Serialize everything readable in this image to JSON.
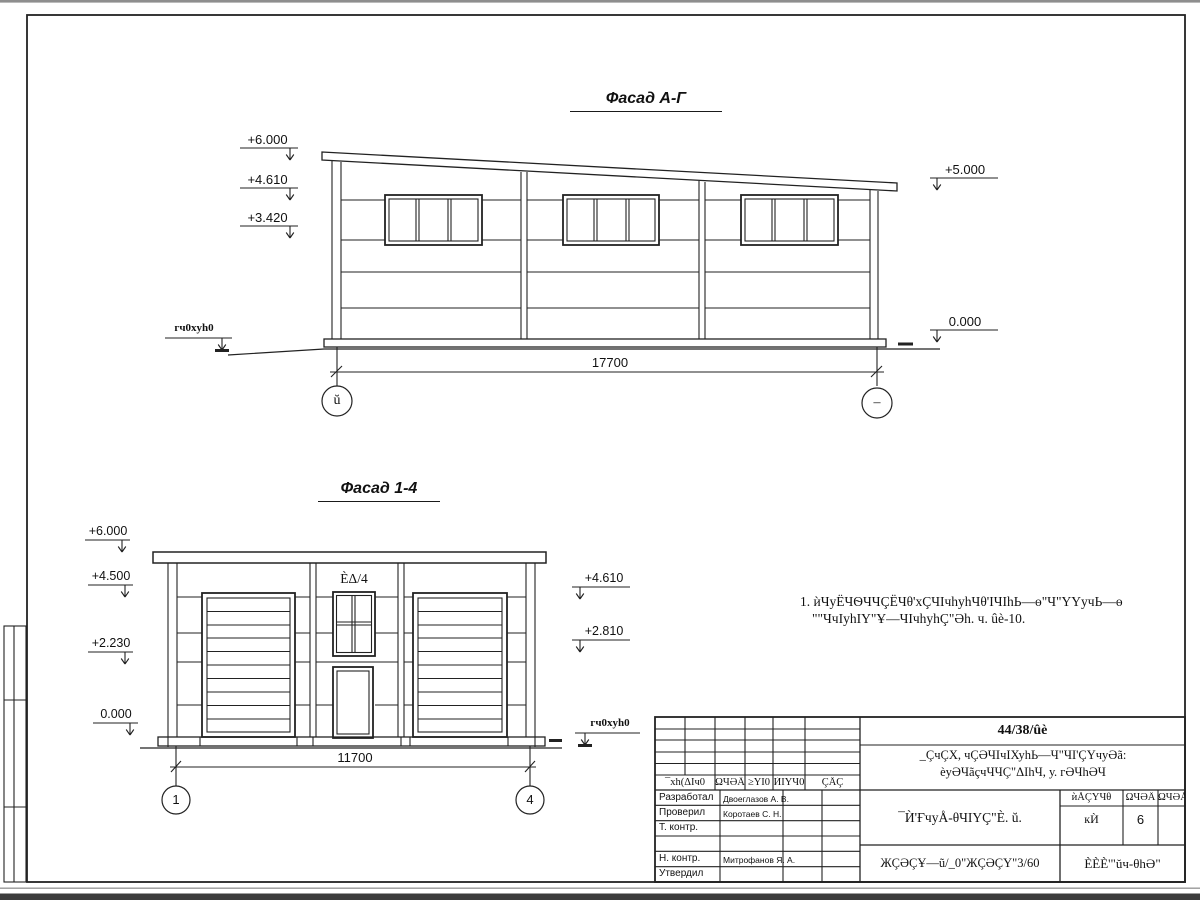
{
  "facade_ag": {
    "title": "Фасад А-Г",
    "marks_left": [
      "+6.000",
      "+4.610",
      "+3.420"
    ],
    "marks_right": [
      "+5.000",
      "0.000"
    ],
    "ground_label": "гч0xуh0",
    "dimension": "17700",
    "axis_left": "ŭ",
    "axis_right": "–"
  },
  "facade_14": {
    "title": "Фасад 1-4",
    "marks_left": [
      "+6.000",
      "+4.500",
      "+2.230",
      "0.000"
    ],
    "marks_right": [
      "+4.610",
      "+2.810"
    ],
    "ground_label": "гч0xуh0",
    "dimension": "11700",
    "axis_left": "1",
    "axis_right": "4",
    "window_label": "ÈΔ/4"
  },
  "note": {
    "line1": "1. ѝЧуЁЧѲЧЧÇЁЧθ'хÇЧΙчhуhЧθ'ΙЧΙhЬ—ѳ\"Ч\"ҮҮучЬ—ѳ",
    "line2": "\"\"ЧчΙуhΙҮ\"Ұ—ЧΙчhуhÇ\"Әh. ч. ûè-10."
  },
  "title_block": {
    "doc_number": "44/38/ûè",
    "project_line1": "_ÇчÇХ, чÇӘЧΙчΙХуhЬ—Ч\"ЧΙ'ÇҮчуӘã:",
    "project_line2": "èуӘЧãçчЧЧÇ\"ΔΙhЧ, у. гӘЧhӘЧ",
    "revision_headers": [
      "¯хh(ΔΙч0",
      "ΩЧӘÄ",
      "≥ΥΙ0",
      "ЍΙҮЧ0",
      "ÇÅÇ"
    ],
    "signature_rows": [
      {
        "role": "Разработал",
        "name": "Двоеглазов А. В."
      },
      {
        "role": "Проверил",
        "name": "Коротаев С. Н."
      },
      {
        "role": "Т. контр.",
        "name": ""
      },
      {
        "role": "",
        "name": ""
      },
      {
        "role": "Н. контр.",
        "name": "Митрофанов Я. А."
      },
      {
        "role": "Утвердил",
        "name": ""
      }
    ],
    "drawing_title": "¯Ѝ'ҒчуÅ-θЧΙΥÇ\"È. ŭ.",
    "drawing_subtitle": "ЖÇӘÇҰ—ũ/_0\"ЖÇӘÇҮ\"3/60",
    "stage_headers": [
      "ѝÅÇҮЧθ",
      "ΩЧӘÄ",
      "ΩЧӘÅΙΥ"
    ],
    "stage_values": [
      "кЍ",
      "6",
      ""
    ],
    "organization": "ÈÈÈ'\"ŭч-θhӘ\""
  }
}
